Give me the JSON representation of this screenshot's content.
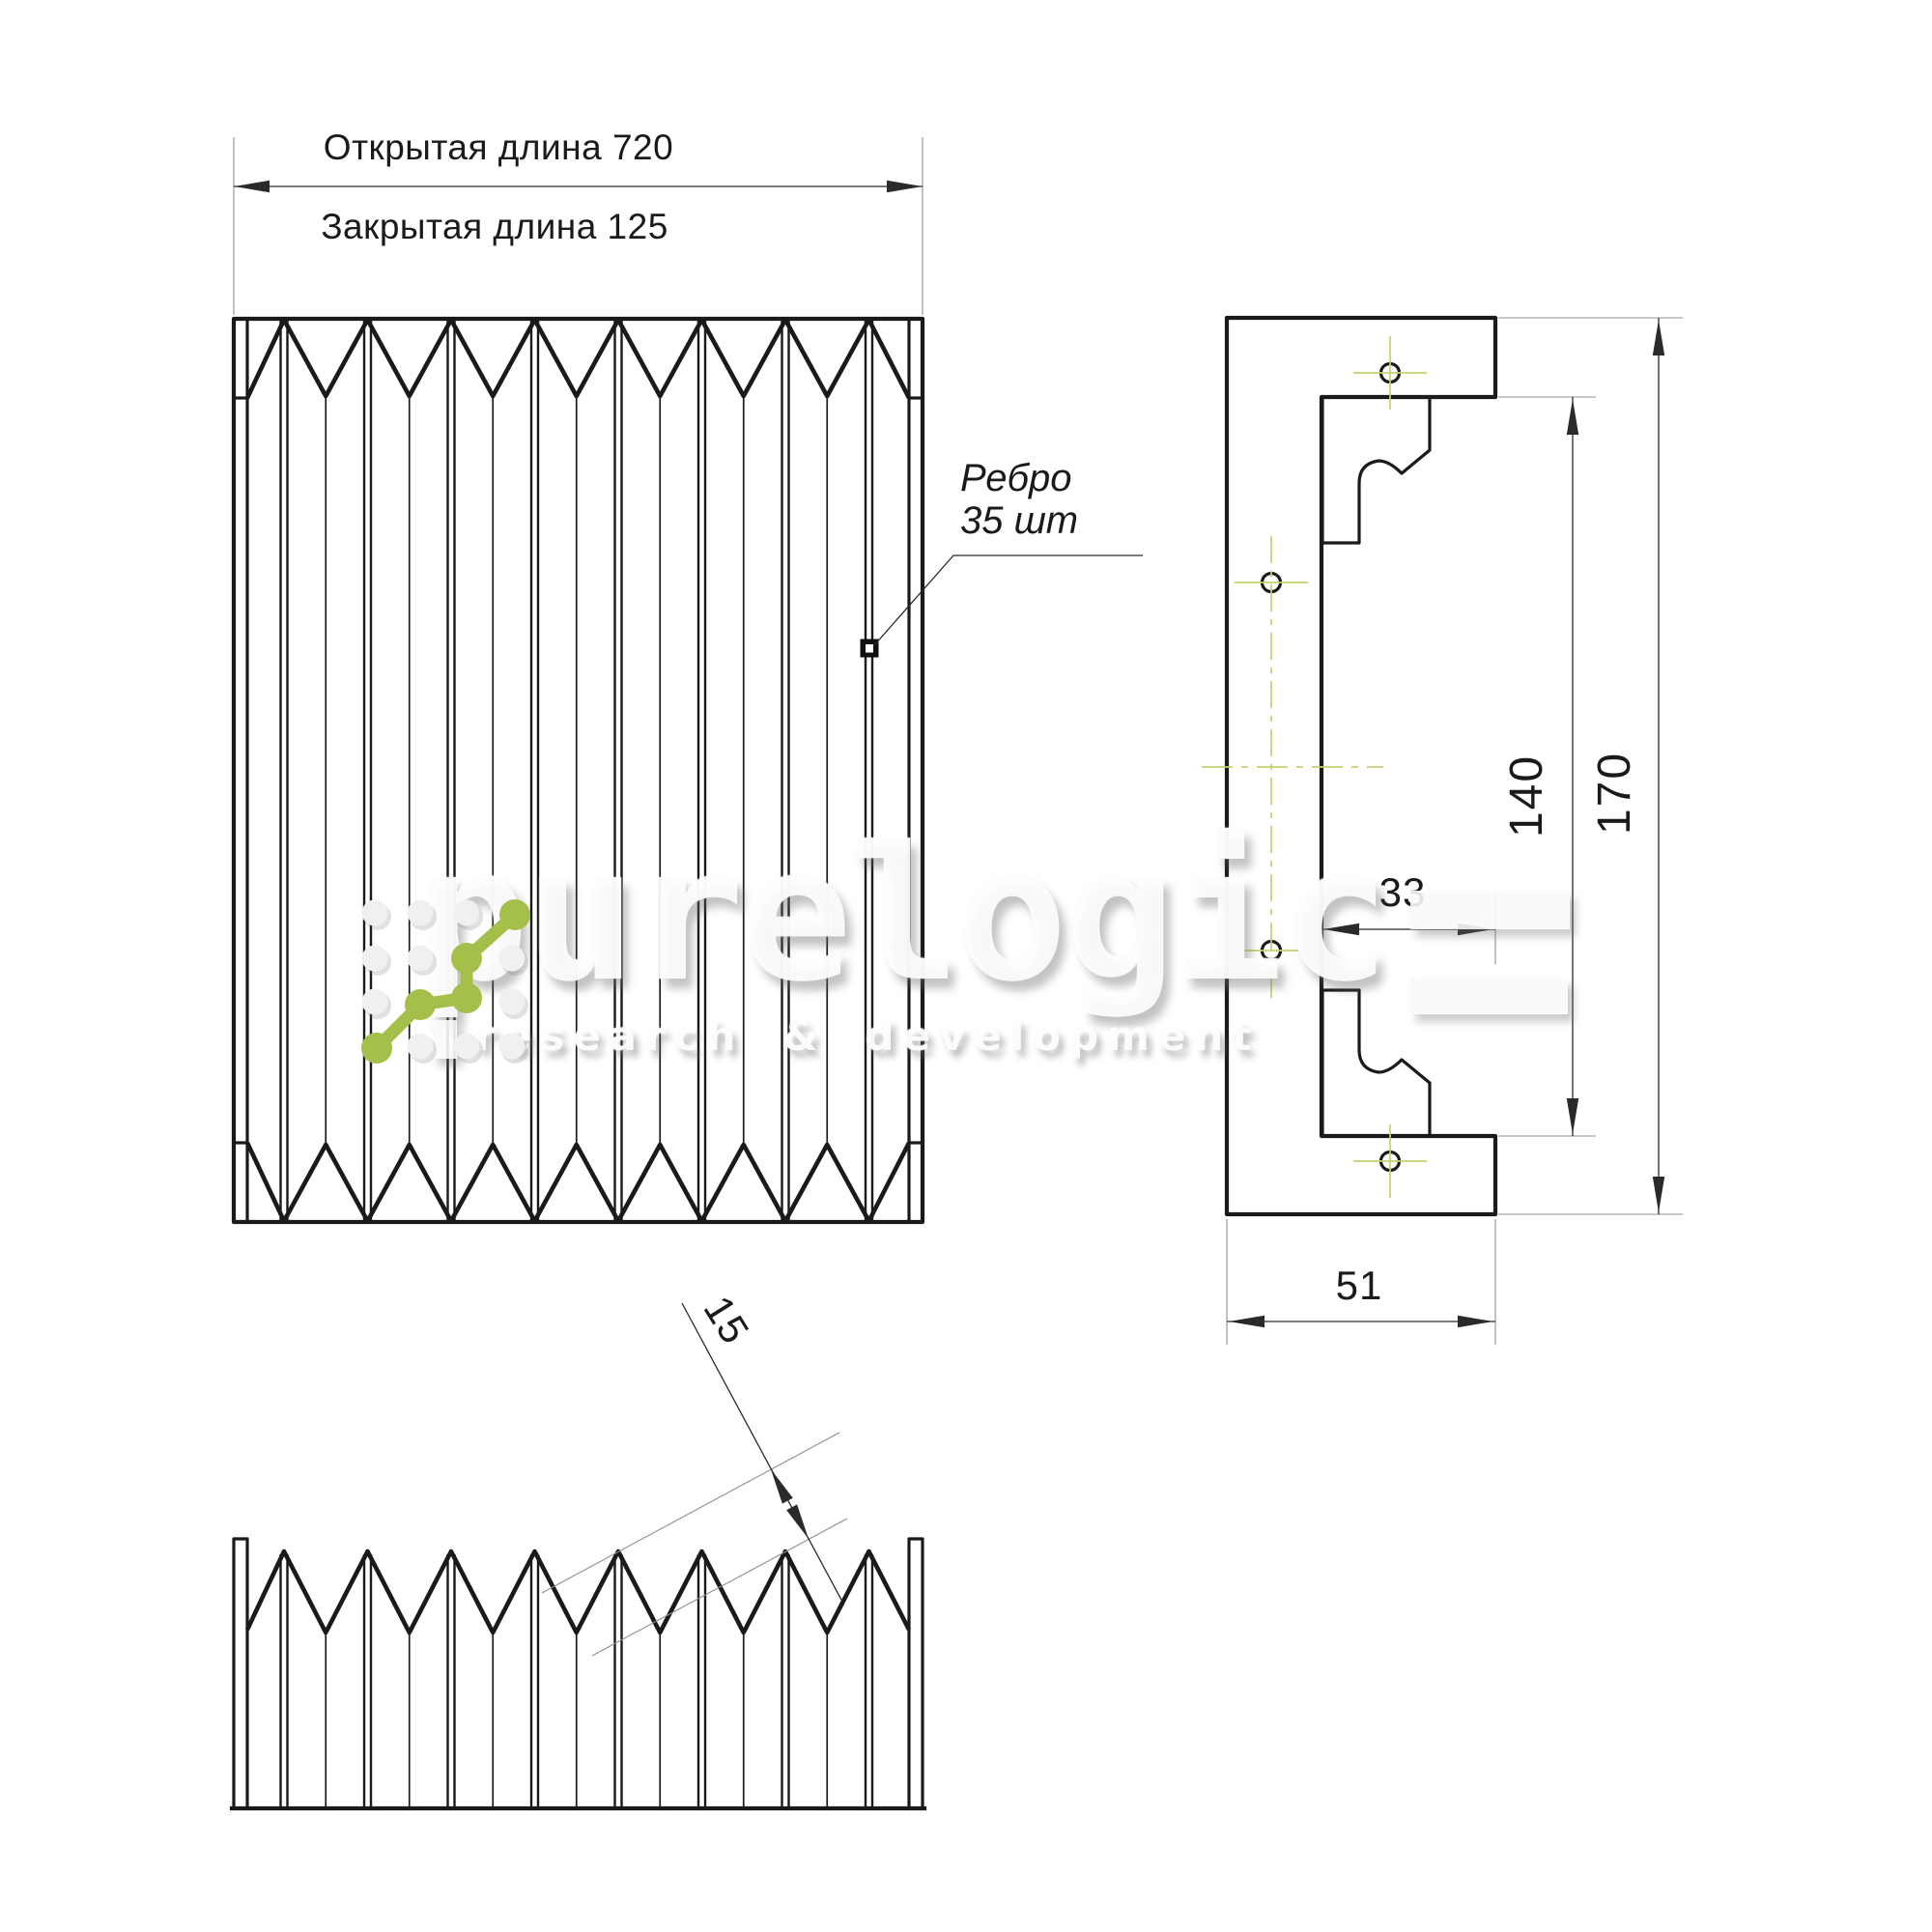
{
  "front_view": {
    "dim_open": "Открытая длина 720",
    "dim_closed": "Закрытая длина 125",
    "rib_label_line1": "Ребро",
    "rib_label_line2": "35 шт"
  },
  "side_view": {
    "dim_inner_height": "140",
    "dim_outer_height": "170",
    "dim_slot": "33",
    "dim_base": "51"
  },
  "bottom_view": {
    "dim_pitch": "15"
  },
  "watermark": {
    "brand": "purelogic",
    "tagline": "research & development"
  },
  "colors": {
    "line": "#1a1a1a",
    "dim": "#2a2a2a",
    "extension": "#8f8f8f",
    "centerline": "#c2d36d",
    "logo_green": "#a5bf4b",
    "pale_dot": "#f0f0f0"
  }
}
